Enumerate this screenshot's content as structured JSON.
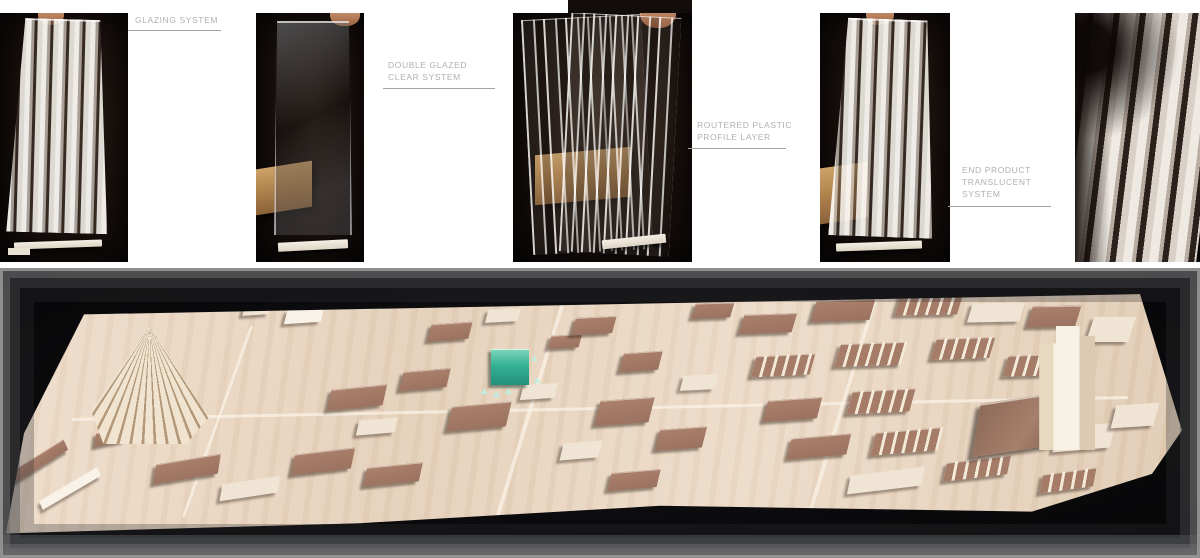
{
  "page": {
    "background": "#ffffff",
    "type": "architecture portfolio sheet"
  },
  "process": {
    "photos": [
      {
        "name": "glazing-system-panel",
        "description": "ribbed translucent glazing panel held upright on white base against dark background"
      },
      {
        "name": "double-glazed-clear-panel",
        "description": "clear double glazed panel held by hand with wood block behind, on white base"
      },
      {
        "name": "routered-plastic-profile-panels",
        "description": "fanned clear routered plastic profile sheets with wood block behind"
      },
      {
        "name": "end-product-translucent-panel",
        "description": "end product translucent ribbed panel on white base with wood block behind"
      },
      {
        "name": "translucent-panel-closeup",
        "description": "close-up detail of ribbed translucent glazing system"
      }
    ],
    "captions": [
      {
        "lines": [
          "GLAZING SYSTEM"
        ]
      },
      {
        "lines": [
          "DOUBLE GLAZED",
          "CLEAR SYSTEM"
        ]
      },
      {
        "lines": [
          "ROUTERED PLASTIC",
          "PROFILE LAYER"
        ]
      },
      {
        "lines": [
          "END PRODUCT",
          "TRANSLUCENT",
          "SYSTEM"
        ]
      }
    ],
    "caption_color": "#b2b0ae",
    "underline_color": "#a6a4a2"
  },
  "model": {
    "description": "wooden site model of a city district photographed on black background with grey framed vignette; proposal building highlighted in teal acrylic; fan-shaped roof structure at left; stepped tower at right",
    "colors": {
      "board": "#e8d5c1",
      "roof_wood": "#a57d69",
      "light_wood": "#f0e5d4",
      "white_wood": "#f8f2e8",
      "accent_green": "#35b295",
      "photo_background": "#0a0a0c",
      "frame_grey": "#969696"
    },
    "landmarks": {
      "fan_structure": {
        "x": 7.6,
        "y": 20,
        "w": 122,
        "h": 118
      },
      "green_building": {
        "x": 40.9,
        "y": 28,
        "w": 38,
        "h": 36
      },
      "tower": {
        "x": 86.6,
        "y": 20,
        "w": 56,
        "h": 124
      },
      "dark_roof_hall": {
        "x": 81.5,
        "y": 44,
        "w": 96,
        "h": 54
      }
    },
    "buildings": [
      {
        "x": 1.2,
        "y": 64,
        "w": 52,
        "h": 13,
        "r": -38,
        "c": "roof"
      },
      {
        "x": 3.4,
        "y": 74,
        "w": 58,
        "h": 11,
        "r": -36,
        "c": "white"
      },
      {
        "x": 8.0,
        "y": 56,
        "w": 30,
        "h": 14,
        "r": -12,
        "c": "roof"
      },
      {
        "x": 13.0,
        "y": 66,
        "w": 62,
        "h": 20,
        "r": -10,
        "c": "roof"
      },
      {
        "x": 18.5,
        "y": 73,
        "w": 56,
        "h": 17,
        "r": -9,
        "c": "light"
      },
      {
        "x": 24.5,
        "y": 63,
        "w": 58,
        "h": 21,
        "r": -7,
        "c": "roof"
      },
      {
        "x": 30.5,
        "y": 68,
        "w": 54,
        "h": 19,
        "r": -6,
        "c": "roof"
      },
      {
        "x": 20.3,
        "y": 12,
        "w": 26,
        "h": 12,
        "r": -4,
        "c": "light"
      },
      {
        "x": 23.8,
        "y": 14,
        "w": 36,
        "h": 14,
        "r": -4,
        "c": "white"
      },
      {
        "x": 27.5,
        "y": 41,
        "w": 54,
        "h": 21,
        "r": -6,
        "c": "roof"
      },
      {
        "x": 33.5,
        "y": 35,
        "w": 46,
        "h": 19,
        "r": -5,
        "c": "roof"
      },
      {
        "x": 29.8,
        "y": 52,
        "w": 38,
        "h": 15,
        "r": -5,
        "c": "light"
      },
      {
        "x": 37.5,
        "y": 47,
        "w": 58,
        "h": 25,
        "r": -5,
        "c": "roof"
      },
      {
        "x": 43.5,
        "y": 40,
        "w": 34,
        "h": 15,
        "r": -4,
        "c": "light"
      },
      {
        "x": 35.8,
        "y": 19,
        "w": 40,
        "h": 17,
        "r": -4,
        "c": "roof"
      },
      {
        "x": 40.6,
        "y": 14,
        "w": 32,
        "h": 13,
        "r": -3,
        "c": "light"
      },
      {
        "x": 45.8,
        "y": 23,
        "w": 30,
        "h": 13,
        "r": -3,
        "c": "roof"
      },
      {
        "x": 47.8,
        "y": 17,
        "w": 40,
        "h": 17,
        "r": -3,
        "c": "roof"
      },
      {
        "x": 51.8,
        "y": 29,
        "w": 38,
        "h": 19,
        "r": -4,
        "c": "roof"
      },
      {
        "x": 49.8,
        "y": 45,
        "w": 53,
        "h": 25,
        "r": -4,
        "c": "roof"
      },
      {
        "x": 54.8,
        "y": 55,
        "w": 46,
        "h": 21,
        "r": -4,
        "c": "roof"
      },
      {
        "x": 46.8,
        "y": 60,
        "w": 38,
        "h": 17,
        "r": -5,
        "c": "light"
      },
      {
        "x": 50.8,
        "y": 70,
        "w": 48,
        "h": 18,
        "r": -5,
        "c": "roof"
      },
      {
        "x": 56.8,
        "y": 37,
        "w": 34,
        "h": 15,
        "r": -3,
        "c": "light"
      },
      {
        "x": 57.8,
        "y": 12,
        "w": 38,
        "h": 15,
        "r": -2,
        "c": "roof"
      },
      {
        "x": 61.8,
        "y": 16,
        "w": 52,
        "h": 19,
        "r": -2,
        "c": "roof"
      },
      {
        "x": 67.8,
        "y": 11,
        "w": 58,
        "h": 21,
        "r": -2,
        "c": "roof"
      },
      {
        "x": 74.8,
        "y": 9,
        "w": 62,
        "h": 21,
        "r": -1,
        "c": "terrace"
      },
      {
        "x": 62.8,
        "y": 30,
        "w": 58,
        "h": 21,
        "r": -3,
        "c": "terrace"
      },
      {
        "x": 69.8,
        "y": 26,
        "w": 66,
        "h": 23,
        "r": -2,
        "c": "terrace"
      },
      {
        "x": 77.8,
        "y": 24,
        "w": 58,
        "h": 21,
        "r": -2,
        "c": "terrace"
      },
      {
        "x": 63.8,
        "y": 45,
        "w": 53,
        "h": 21,
        "r": -4,
        "c": "roof"
      },
      {
        "x": 70.8,
        "y": 42,
        "w": 62,
        "h": 23,
        "r": -3,
        "c": "terrace"
      },
      {
        "x": 65.8,
        "y": 58,
        "w": 58,
        "h": 21,
        "r": -5,
        "c": "roof"
      },
      {
        "x": 72.8,
        "y": 56,
        "w": 66,
        "h": 23,
        "r": -5,
        "c": "terrace"
      },
      {
        "x": 70.8,
        "y": 70,
        "w": 72,
        "h": 19,
        "r": -7,
        "c": "light"
      },
      {
        "x": 78.8,
        "y": 66,
        "w": 62,
        "h": 19,
        "r": -7,
        "c": "terrace"
      },
      {
        "x": 80.8,
        "y": 12,
        "w": 52,
        "h": 19,
        "r": -1,
        "c": "light"
      },
      {
        "x": 85.8,
        "y": 13,
        "w": 48,
        "h": 21,
        "r": -1,
        "c": "roof"
      },
      {
        "x": 90.8,
        "y": 17,
        "w": 42,
        "h": 25,
        "r": 0,
        "c": "light"
      },
      {
        "x": 83.8,
        "y": 30,
        "w": 52,
        "h": 21,
        "r": -2,
        "c": "terrace"
      },
      {
        "x": 88.0,
        "y": 54,
        "w": 56,
        "h": 25,
        "r": -5,
        "c": "light"
      },
      {
        "x": 86.8,
        "y": 70,
        "w": 52,
        "h": 19,
        "r": -8,
        "c": "terrace"
      },
      {
        "x": 92.8,
        "y": 47,
        "w": 42,
        "h": 23,
        "r": -4,
        "c": "light"
      }
    ]
  }
}
